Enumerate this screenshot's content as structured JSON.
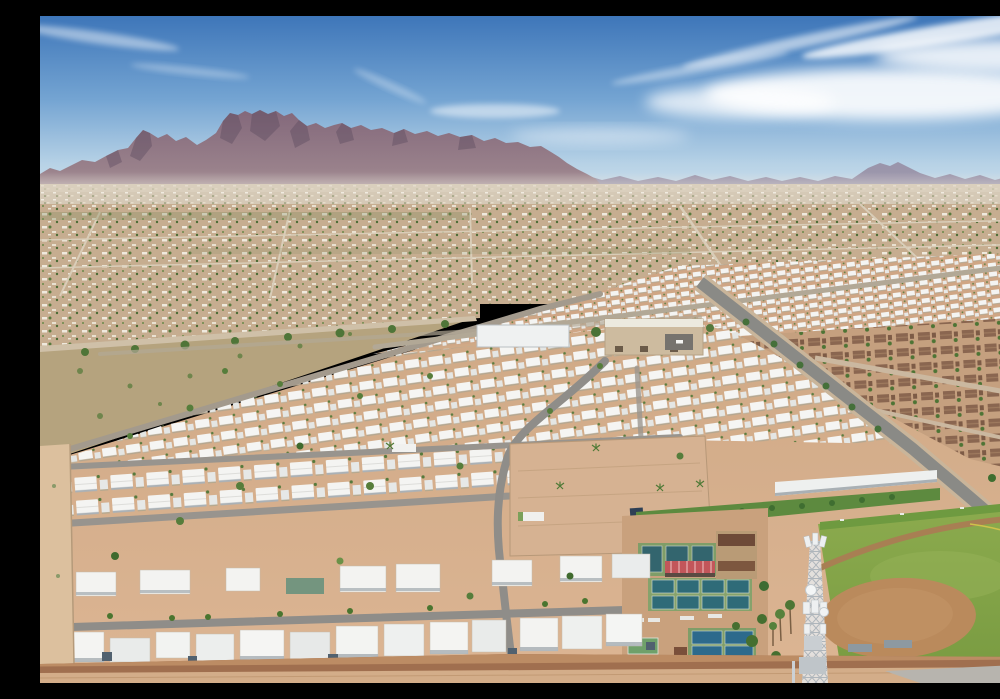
{
  "meta": {
    "type": "aerial-drone-photograph",
    "alt": "Aerial drone view of a large desert mobile-home community with the Superstition Mountains on the horizon under a blue sky with wispy clouds",
    "description": "Aerial photo: rows of white-roofed mobile homes on tan desert lots stretch toward a mountain range; amenities include green pickleball and tennis courts with a red shade canopy, a softball field with dirt infield, a beige clubhouse, an RV storage lot, palm trees, a lattice cell tower in the foreground, a brown-roofed stucco neighborhood across a diagonal road, and a perimeter block wall along the bottom edge."
  },
  "scene": {
    "sky": {
      "label": "blue sky with wispy cirrus clouds",
      "top_color": "#3e76b9",
      "horizon_color": "#d3e2ec",
      "cloud_color": "#ffffff"
    },
    "mountains": {
      "label": "Superstition Mountains ridge",
      "color": "#8a7185",
      "shadow_color": "#5c4b5f",
      "distant_color": "#94879e"
    },
    "valley": {
      "label": "distant desert suburban sprawl",
      "ground_color": "#c6ad90",
      "rooftop_color": "#efe9dd",
      "tree_color": "#587a3e"
    },
    "park": {
      "label": "mobile home park",
      "dirt_color": "#d2ab8c",
      "roof_color": "#f5f5f3",
      "street_color": "#8f8d89",
      "clubhouse_color": "#cdbb9f",
      "perimeter_wall_color": "#a06f4f"
    },
    "recreation": {
      "courts": {
        "label": "pickleball and tennis courts",
        "surround_color": "#83a066",
        "court_color": "#2f6b78",
        "lower_court_color": "#2d6a8c",
        "canopy_color": "#c2565a",
        "count_blocks": 3
      },
      "ballfield": {
        "label": "softball field",
        "grass_color": "#83a548",
        "infield_color": "#ba8a5c",
        "track_color": "#a87f53"
      },
      "cell_tower": {
        "label": "lattice cellular tower with dishes",
        "color": "#dde0e3"
      }
    },
    "neighborhood_right": {
      "label": "brown-roofed stucco houses",
      "roof_color": "#8a6650",
      "ground_color": "#c5a07f"
    },
    "foreground_bottom": {
      "label": "perimeter block wall and dirt shoulder",
      "wall_color": "#a06f4f",
      "dirt_color": "#d3ad89",
      "pavement_color": "#b7b4ae"
    }
  }
}
